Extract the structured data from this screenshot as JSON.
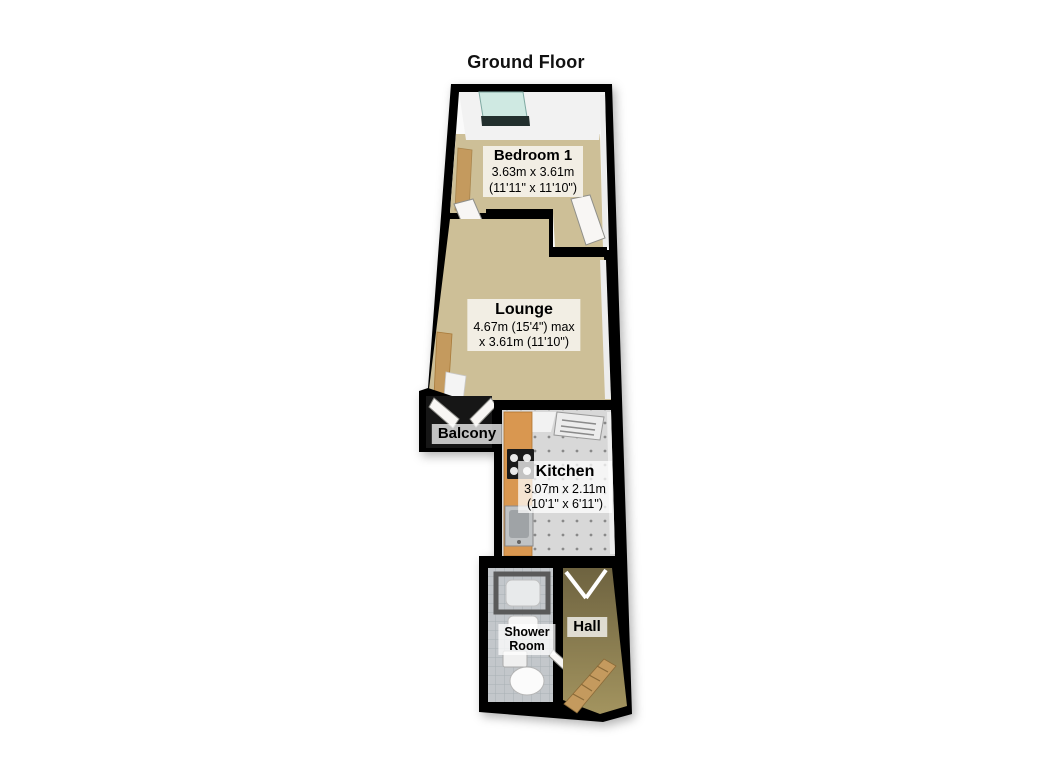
{
  "title": "Ground Floor",
  "rooms": {
    "bedroom": {
      "name": "Bedroom 1",
      "dim_metric": "3.63m x 3.61m",
      "dim_imperial": "(11'11\" x 11'10\")"
    },
    "lounge": {
      "name": "Lounge",
      "dim_line1": "4.67m (15'4\") max",
      "dim_line2": "x 3.61m (11'10\")"
    },
    "balcony": {
      "name": "Balcony"
    },
    "kitchen": {
      "name": "Kitchen",
      "dim_metric": "3.07m x 2.11m",
      "dim_imperial": "(10'1\" x 6'11\")"
    },
    "shower_room": {
      "name_line1": "Shower",
      "name_line2": "Room"
    },
    "hall": {
      "name": "Hall"
    }
  },
  "furniture_icons": [
    "bay-window",
    "wardrobe",
    "door",
    "balcony-doors",
    "kitchen-counter",
    "hob",
    "kitchen-sink",
    "boiler-vent",
    "shower-enclosure",
    "bathroom-sink",
    "toilet",
    "stairs",
    "door-swing"
  ],
  "colors": {
    "wall": "#000000",
    "floor": "#cdbf97",
    "kitchen-floor": "#d8d8d8",
    "shower-floor": "#c3c7cb",
    "balcony": "#161616",
    "counter": "#d99750",
    "wood": "#c49a5e",
    "glass": "#cfe9e2",
    "door": "#f8f6f4",
    "hall-top": "#6e6340",
    "hall-bottom": "#a3945f"
  }
}
